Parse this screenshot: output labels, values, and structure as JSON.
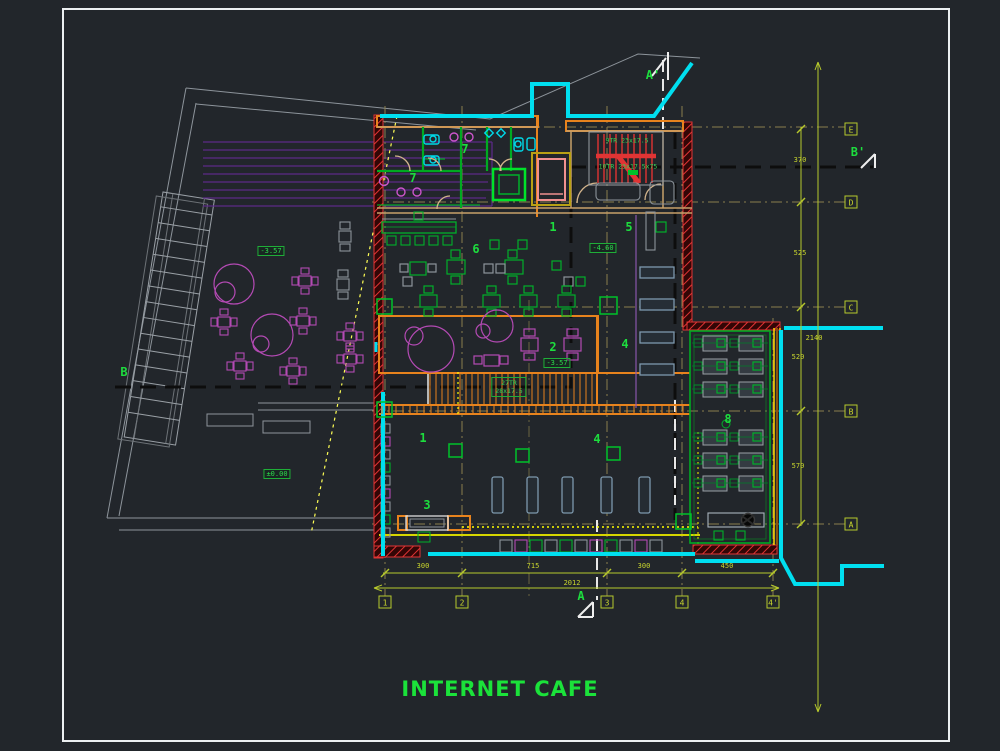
{
  "title": "INTERNET CAFE",
  "palette": {
    "background": "#22262b",
    "frame": "#eceff1",
    "cyan_site": "#00dff0",
    "wall_red": "#e03434",
    "wall_orange": "#e8831d",
    "wall_tan": "#c8a06a",
    "wall_green": "#00aa22",
    "furniture_green": "#00b02a",
    "furniture_magenta": "#b44ab4",
    "table_bluegray": "#7d98ad",
    "grid_olive": "#8a7f4d",
    "dim_yellow_green": "#b7c92c",
    "title_green": "#1be23a",
    "door_tan": "#d2b48c",
    "elevator_pink": "#f09090"
  },
  "labels": {
    "rooms": [
      {
        "t": "7",
        "x": 465,
        "y": 149
      },
      {
        "t": "7",
        "x": 413,
        "y": 178
      },
      {
        "t": "1",
        "x": 553,
        "y": 227
      },
      {
        "t": "6",
        "x": 476,
        "y": 249
      },
      {
        "t": "5",
        "x": 629,
        "y": 227
      },
      {
        "t": "2",
        "x": 553,
        "y": 347
      },
      {
        "t": "4",
        "x": 625,
        "y": 344
      },
      {
        "t": "1",
        "x": 423,
        "y": 438
      },
      {
        "t": "3",
        "x": 427,
        "y": 505
      },
      {
        "t": "4",
        "x": 597,
        "y": 439
      },
      {
        "t": "8",
        "x": 728,
        "y": 419
      }
    ],
    "levels": [
      {
        "t": "-3.57",
        "x": 271,
        "y": 251
      },
      {
        "t": "-3.57",
        "x": 557,
        "y": 363
      },
      {
        "t": "±0.00",
        "x": 277,
        "y": 474
      },
      {
        "t": "-4.60",
        "x": 603,
        "y": 248
      }
    ],
    "stair_notes": [
      {
        "t": "9TR 23x17.5",
        "x": 627,
        "y": 141
      },
      {
        "t": "10TR 23x17.5x75",
        "x": 628,
        "y": 167
      }
    ],
    "stair_note_box": {
      "line1": "27TR",
      "line2": "28x17.5",
      "x": 509,
      "y": 387
    },
    "sections": [
      {
        "t": "A'",
        "x": 653,
        "y": 75
      },
      {
        "t": "A",
        "x": 581,
        "y": 596
      },
      {
        "t": "B",
        "x": 124,
        "y": 372
      },
      {
        "t": "B'",
        "x": 858,
        "y": 152
      }
    ]
  },
  "grid": {
    "bubbles_bottom": {
      "y": 602,
      "items": [
        {
          "t": "1",
          "x": 385
        },
        {
          "t": "2",
          "x": 462
        },
        {
          "t": "3",
          "x": 607
        },
        {
          "t": "4",
          "x": 682
        },
        {
          "t": "4'",
          "x": 773
        }
      ]
    },
    "bubbles_right": {
      "x": 851,
      "items": [
        {
          "t": "E",
          "y": 129
        },
        {
          "t": "D",
          "y": 202
        },
        {
          "t": "C",
          "y": 307
        },
        {
          "t": "B",
          "y": 411
        },
        {
          "t": "A",
          "y": 524
        }
      ]
    }
  },
  "dimensions": {
    "bottom": {
      "segments": [
        {
          "t": "300",
          "x": 423,
          "y": 566
        },
        {
          "t": "715",
          "x": 533,
          "y": 566
        },
        {
          "t": "300",
          "x": 644,
          "y": 566
        },
        {
          "t": "450",
          "x": 727,
          "y": 566
        }
      ],
      "total": {
        "t": "2012",
        "x": 572,
        "y": 583
      }
    },
    "right": {
      "segments": [
        {
          "t": "370",
          "x": 800,
          "y": 160
        },
        {
          "t": "525",
          "x": 800,
          "y": 253
        },
        {
          "t": "520",
          "x": 798,
          "y": 357
        },
        {
          "t": "570",
          "x": 798,
          "y": 466
        }
      ],
      "total": {
        "t": "2140",
        "x": 814,
        "y": 338
      }
    }
  }
}
